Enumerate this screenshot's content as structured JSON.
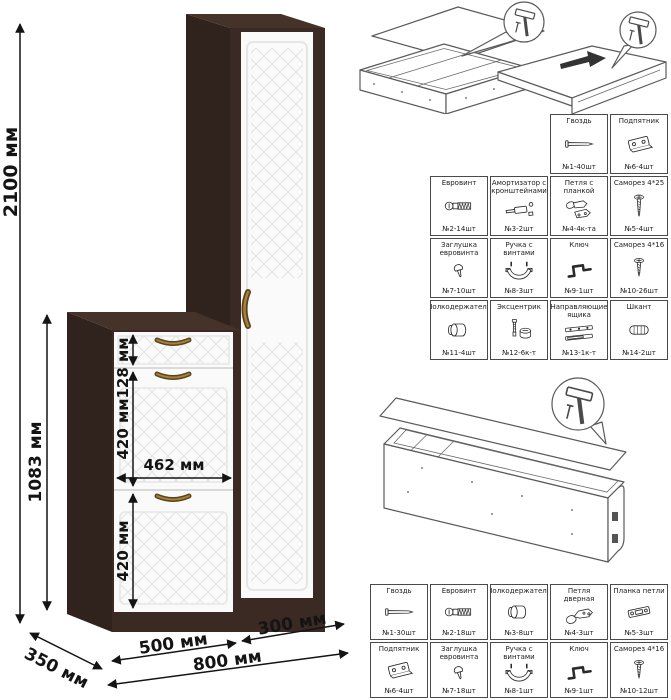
{
  "furniture": {
    "dims": {
      "total_height": "2100 мм",
      "cabinet_height": "1083 мм",
      "drawer_height": "128 мм",
      "flap1_height": "420 мм",
      "flap2_height": "420 мм",
      "inner_width": "462 мм",
      "cabinet_width": "500 мм",
      "column_width": "300 мм",
      "total_width": "800 мм",
      "depth": "350 мм"
    },
    "colors": {
      "wood": "#3a2a23",
      "wood_top": "#453229",
      "wood_side": "#30221c",
      "door": "#fafafa",
      "pattern_line": "#e3e3e3",
      "handle_brass": "#8a6a2c"
    }
  },
  "tables": {
    "top": {
      "rows": [
        [
          {
            "name": "Гвоздь",
            "qty": "№1-40шт",
            "icon": "nail"
          },
          {
            "name": "Подпятник",
            "qty": "№6-4шт",
            "icon": "glide-plate"
          }
        ],
        [
          {
            "name": "Евровинт",
            "qty": "№2-14шт",
            "icon": "confirmat"
          },
          {
            "name": "Амортизатор с кронштейнами",
            "qty": "№3-2шт",
            "icon": "gas-lift"
          },
          {
            "name": "Петля с планкой",
            "qty": "№4-4к-та",
            "icon": "hinge-with-plate"
          },
          {
            "name": "Саморез 4*25",
            "qty": "№5-4шт",
            "icon": "screw-long"
          }
        ],
        [
          {
            "name": "Заглушка евровинта",
            "qty": "№7-10шт",
            "icon": "cap"
          },
          {
            "name": "Ручка с винтами",
            "qty": "№8-3шт",
            "icon": "handle-with-screws"
          },
          {
            "name": "Ключ",
            "qty": "№9-1шт",
            "icon": "hex-key"
          },
          {
            "name": "Саморез 4*16",
            "qty": "№10-26шт",
            "icon": "screw-short"
          }
        ],
        [
          {
            "name": "Полкодержатель",
            "qty": "№11-4шт",
            "icon": "shelf-support"
          },
          {
            "name": "Эксцентрик",
            "qty": "№12-6к-т",
            "icon": "cam-lock"
          },
          {
            "name": "Направляющие ящика",
            "qty": "№13-1к-т",
            "icon": "drawer-slides"
          },
          {
            "name": "Шкант",
            "qty": "№14-2шт",
            "icon": "dowel"
          }
        ]
      ]
    },
    "bottom": {
      "rows": [
        [
          {
            "name": "Гвоздь",
            "qty": "№1-30шт",
            "icon": "nail"
          },
          {
            "name": "Евровинт",
            "qty": "№2-18шт",
            "icon": "confirmat"
          },
          {
            "name": "Полкодержатель",
            "qty": "№3-8шт",
            "icon": "shelf-support"
          },
          {
            "name": "Петля дверная",
            "qty": "№4-3шт",
            "icon": "door-hinge"
          },
          {
            "name": "Планка петли",
            "qty": "№5-3шт",
            "icon": "hinge-plate"
          }
        ],
        [
          {
            "name": "Подпятник",
            "qty": "№6-4шт",
            "icon": "glide-plate"
          },
          {
            "name": "Заглушка евровинта",
            "qty": "№7-18шт",
            "icon": "cap"
          },
          {
            "name": "Ручка с винтами",
            "qty": "№8-1шт",
            "icon": "handle-with-screws"
          },
          {
            "name": "Ключ",
            "qty": "№9-1шт",
            "icon": "hex-key"
          },
          {
            "name": "Саморез 4*16",
            "qty": "№10-12шт",
            "icon": "screw-short"
          }
        ]
      ]
    }
  }
}
